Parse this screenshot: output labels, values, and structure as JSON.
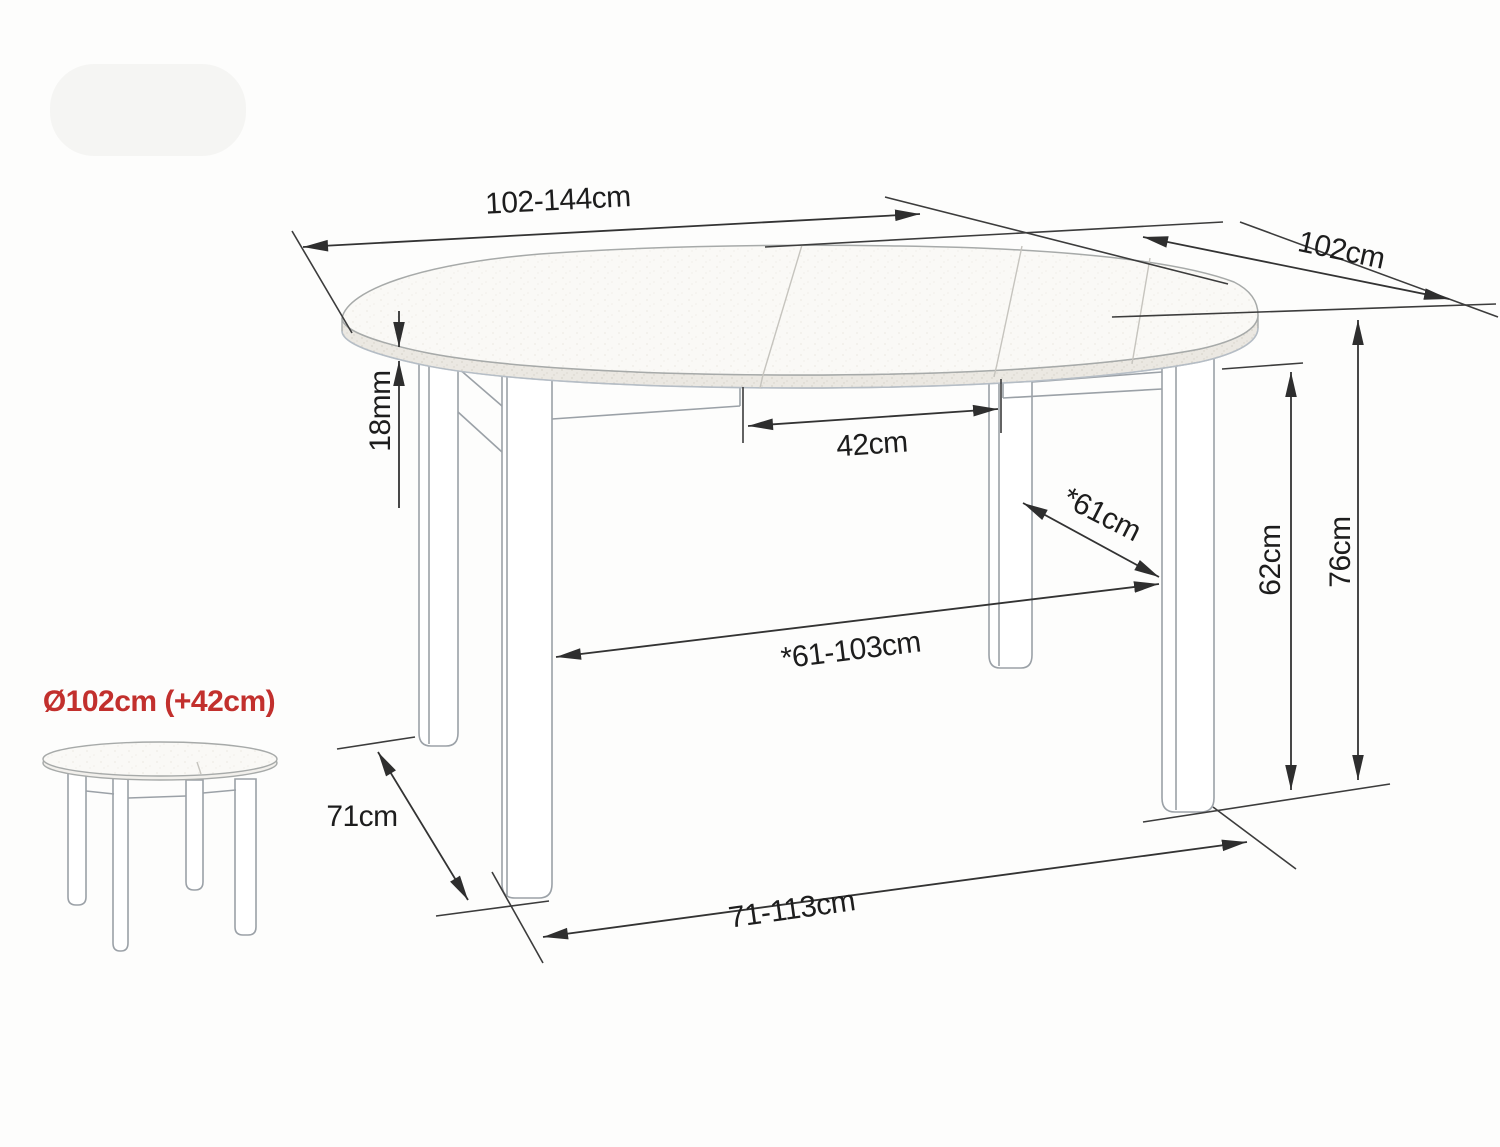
{
  "diagram": {
    "kind": "furniture dimension drawing",
    "subject": "extendable round dining table",
    "colors": {
      "background": "#fdfdfc",
      "dimension_lines": "#333333",
      "drawing_lines": "#9ba1a7",
      "accent_red": "#c2302d",
      "surface_fill": "#faf9f6",
      "edge_band_fill": "#ebe8e2",
      "blue_tint": "#b9c3cf"
    },
    "labels": {
      "top_length": "102-144cm",
      "top_depth": "102cm",
      "top_thickness": "18mm",
      "leaf_width": "42cm",
      "leg_span_diagonal": "*61cm",
      "underframe_clearance": "62cm",
      "table_height": "76cm",
      "leg_span_length": "*61-103cm",
      "base_depth": "71cm",
      "base_length": "71-113cm",
      "inset_diameter": "Ø102cm (+42cm)"
    }
  }
}
